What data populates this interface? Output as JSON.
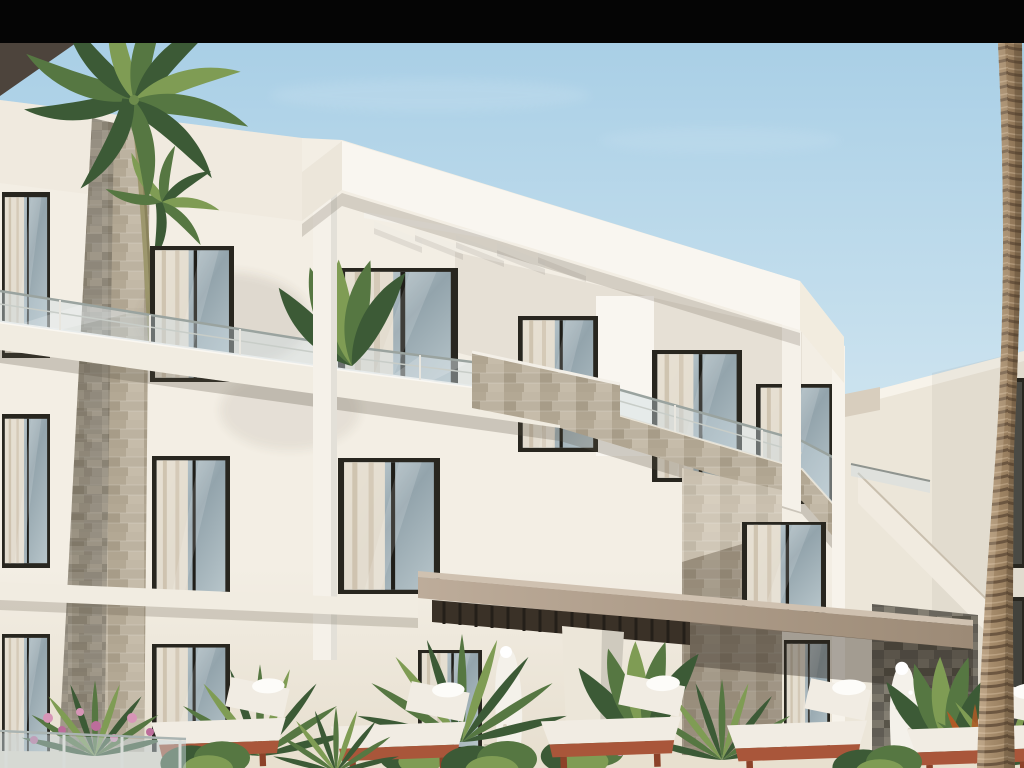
{
  "scene": {
    "type": "architectural-exterior-render",
    "subject": "Modern white three-storey apartment building with glass-railed balconies, travertine stone cladding, palm trees, tropical planting, sun loungers and splash fountains under a clear blue sky",
    "sky": "clear light blue",
    "letterbox_top_bar": true,
    "letterbox_bottom_bar": false
  },
  "counts": {
    "visible_floors": 3,
    "sun_loungers": 5,
    "fountains": 2,
    "left_palm_crowns": 2,
    "right_palm_trunks": 1,
    "pergola_fins": 5
  },
  "colors": {
    "bar": "#050505",
    "sky_top": "#a9cfe6",
    "sky_mid": "#c9e1ee",
    "sky_low": "#e3f1f7",
    "wedge": "#4d443c",
    "wall_hi": "#f3eee4",
    "wall_lo": "#e6dece",
    "wall2": "#ece6d9",
    "fascia": "#f9f6f0",
    "pillar": "#f5f1e9",
    "stone": "#b5ab9a",
    "stone_dk": "#6e6a61",
    "frame": "#28261f",
    "glass_hi": "#cdd9dd",
    "glass_lo": "#93a4ac",
    "curtain": "#e9e1d1",
    "curtain_sh": "#c9bda7",
    "canopy_hi": "#bdac9a",
    "canopy_lo": "#9c8a76",
    "slat": "#3a3127",
    "ter": "#a9563a",
    "ter_dk": "#8c4229",
    "cush": "#f1ece3",
    "leaf_dark": "#3c5a36",
    "leaf_mid": "#567742",
    "leaf_light": "#7f9c54",
    "croton": "#b05a26",
    "trunk_hi": "#b29878",
    "trunk_lo": "#8a7154",
    "trunk_ring": "#66513c",
    "flower": "#d795b7",
    "flower_dk": "#bc6d9b",
    "deck": "#e8e0cf",
    "fountain": "#f4f1ea"
  }
}
